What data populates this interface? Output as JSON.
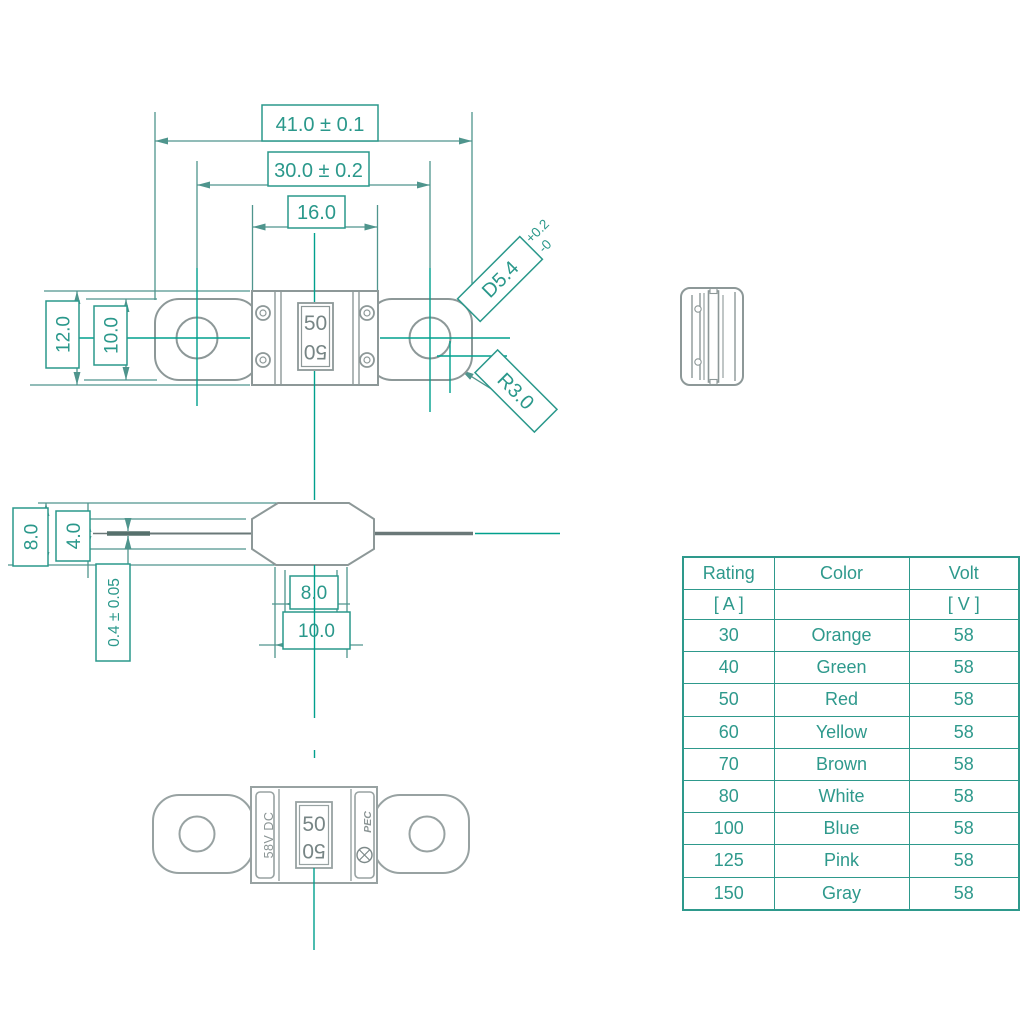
{
  "drawing": {
    "top_view": {
      "dim_overall_length": "41.0 ± 0.1",
      "dim_hole_pitch": "30.0 ± 0.2",
      "dim_body_width": "16.0",
      "dim_overall_height": "12.0",
      "dim_terminal_height": "10.0",
      "hole_diameter": "D5.4",
      "hole_tol_plus": "+0.2",
      "hole_tol_minus": "-0",
      "corner_radius": "R3.0",
      "marking": "50"
    },
    "side_view": {
      "dim_height": "8.0",
      "dim_body_mid": "4.0",
      "dim_terminal_thickness": "0.4 ± 0.05",
      "dim_base_inner": "8.0",
      "dim_base_outer": "10.0"
    },
    "bottom_view": {
      "marking": "50",
      "voltage_marking": "58V DC",
      "brand": "PEC"
    }
  },
  "table": {
    "headers": [
      "Rating",
      "Color",
      "Volt"
    ],
    "units": [
      "[ A ]",
      "",
      "[ V ]"
    ],
    "rows": [
      {
        "rating": "30",
        "color": "Orange",
        "volt": "58"
      },
      {
        "rating": "40",
        "color": "Green",
        "volt": "58"
      },
      {
        "rating": "50",
        "color": "Red",
        "volt": "58"
      },
      {
        "rating": "60",
        "color": "Yellow",
        "volt": "58"
      },
      {
        "rating": "70",
        "color": "Brown",
        "volt": "58"
      },
      {
        "rating": "80",
        "color": "White",
        "volt": "58"
      },
      {
        "rating": "100",
        "color": "Blue",
        "volt": "58"
      },
      {
        "rating": "125",
        "color": "Pink",
        "volt": "58"
      },
      {
        "rating": "150",
        "color": "Gray",
        "volt": "58"
      }
    ]
  },
  "colors": {
    "teal_text": "#2a988b",
    "dimension_line": "#4f958d",
    "center_line": "#00a08d",
    "part_outline": "#8d9898"
  }
}
